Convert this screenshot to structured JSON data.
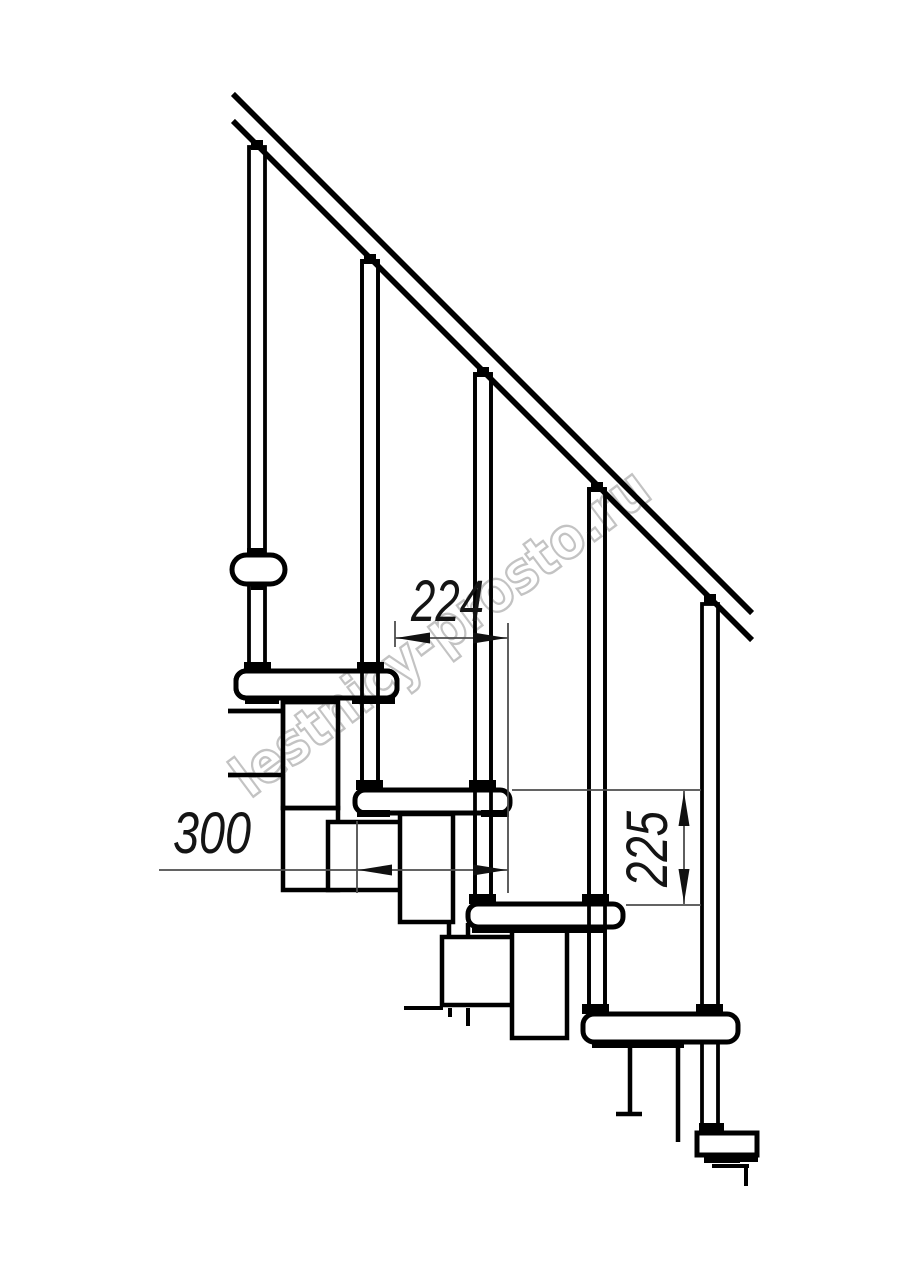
{
  "watermark": {
    "text": "lestnicy-prosto.ru",
    "color": "#c3c3c3"
  },
  "dimensions": {
    "step_run": {
      "value": "224",
      "orientation": "horizontal"
    },
    "tread_depth": {
      "value": "300",
      "orientation": "horizontal"
    },
    "riser_height": {
      "value": "225",
      "orientation": "vertical"
    }
  },
  "colors": {
    "background": "#ffffff",
    "drawing_line": "#000000",
    "dimension_line": "#4d4d4d",
    "dimension_text": "#141414"
  }
}
